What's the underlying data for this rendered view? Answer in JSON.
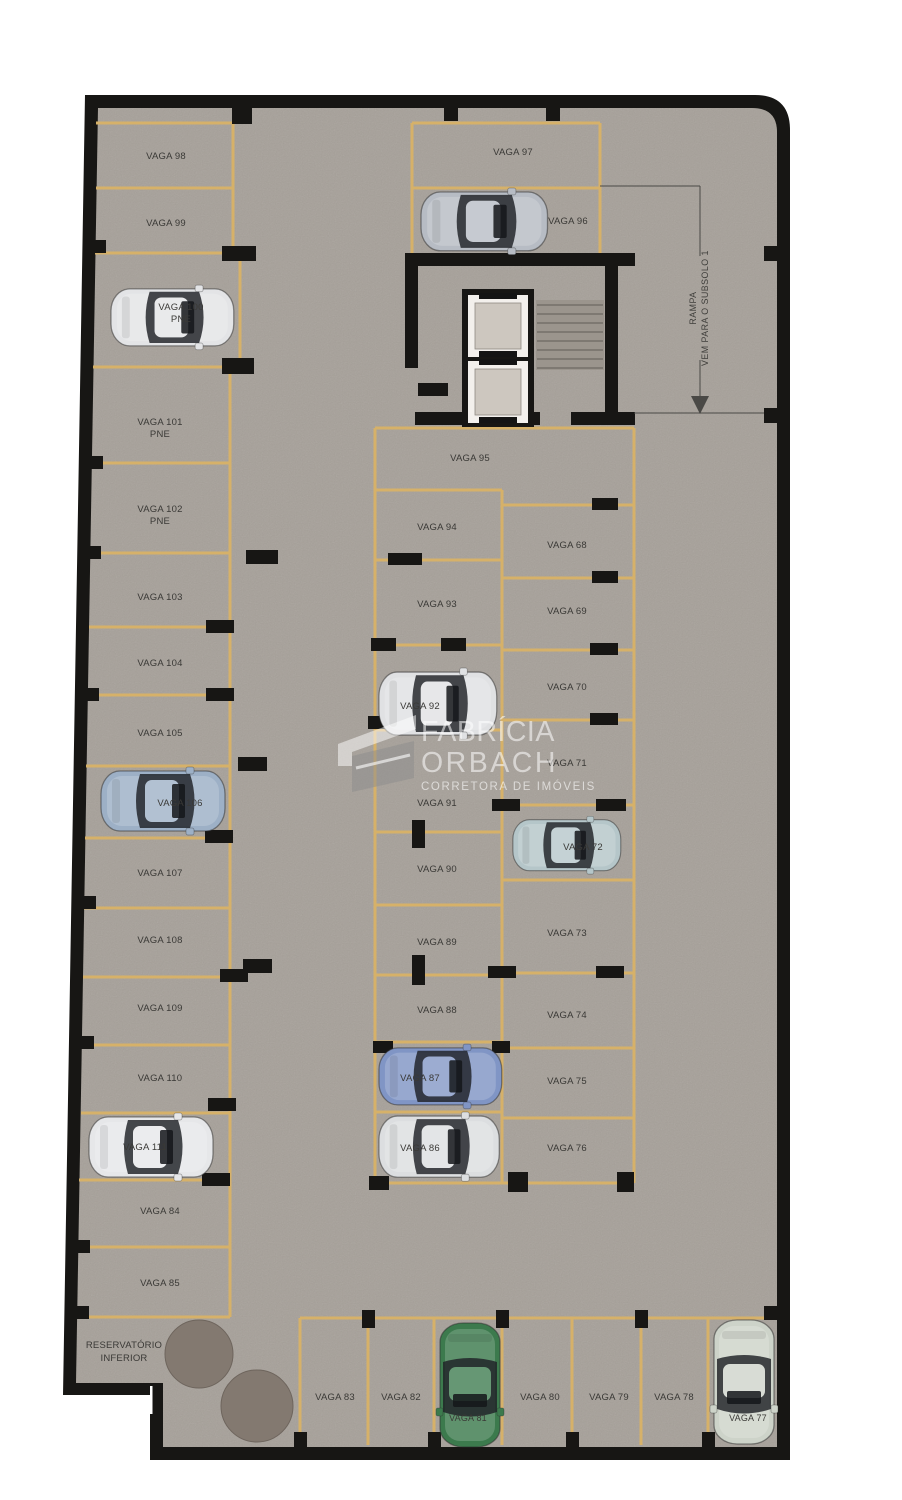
{
  "plan_title": "Pavimento de garagem (subsolo) - planta de vagas",
  "spots": {
    "68": "VAGA 68",
    "69": "VAGA 69",
    "70": "VAGA 70",
    "71": "VAGA 71",
    "72": "VAGA 72",
    "73": "VAGA 73",
    "74": "VAGA 74",
    "75": "VAGA 75",
    "76": "VAGA 76",
    "77": "VAGA 77",
    "78": "VAGA 78",
    "79": "VAGA 79",
    "80": "VAGA 80",
    "81": "VAGA 81",
    "82": "VAGA 82",
    "83": "VAGA 83",
    "84": "VAGA 84",
    "85": "VAGA 85",
    "86": "VAGA 86",
    "87": "VAGA 87",
    "88": "VAGA 88",
    "89": "VAGA 89",
    "90": "VAGA 90",
    "91": "VAGA 91",
    "92": "VAGA 92",
    "93": "VAGA 93",
    "94": "VAGA 94",
    "95": "VAGA 95",
    "96": "VAGA 96",
    "97": "VAGA 97",
    "98": "VAGA 98",
    "99": "VAGA 99",
    "100": "VAGA 100",
    "101": "VAGA 101",
    "102": "VAGA 102",
    "103": "VAGA 103",
    "104": "VAGA 104",
    "105": "VAGA 105",
    "106": "VAGA 106",
    "107": "VAGA 107",
    "108": "VAGA 108",
    "109": "VAGA 109",
    "110": "VAGA 110",
    "111": "VAGA 111"
  },
  "annotations": {
    "pne": "PNE",
    "ramp_line1": "RAMPA",
    "ramp_line2": "VEM PARA O SUBSOLO 1",
    "reservoir_line1": "RESERVATÓRIO",
    "reservoir_line2": "INFERIOR"
  },
  "watermark": {
    "line1": "FABRÍCIA",
    "line2": "ORBACH",
    "line3": "CORRETORA DE IMÓVEIS"
  },
  "colors": {
    "floor": "#a6a099",
    "wall": "#171614",
    "stripe": "#d6b169",
    "label": "#3a3936",
    "tank": "#837970",
    "stair_line": "#6e6962"
  },
  "cars": {
    "100": "#e3e4e6",
    "96": "#b7bcc4",
    "106": "#9db0c6",
    "111": "#e6e7e9",
    "92": "#e0e1e3",
    "72": "#b5c6c9",
    "87": "#8095c5",
    "86": "#dcdee0",
    "81": "#3c7a4d",
    "77": "#cdd3c9"
  }
}
